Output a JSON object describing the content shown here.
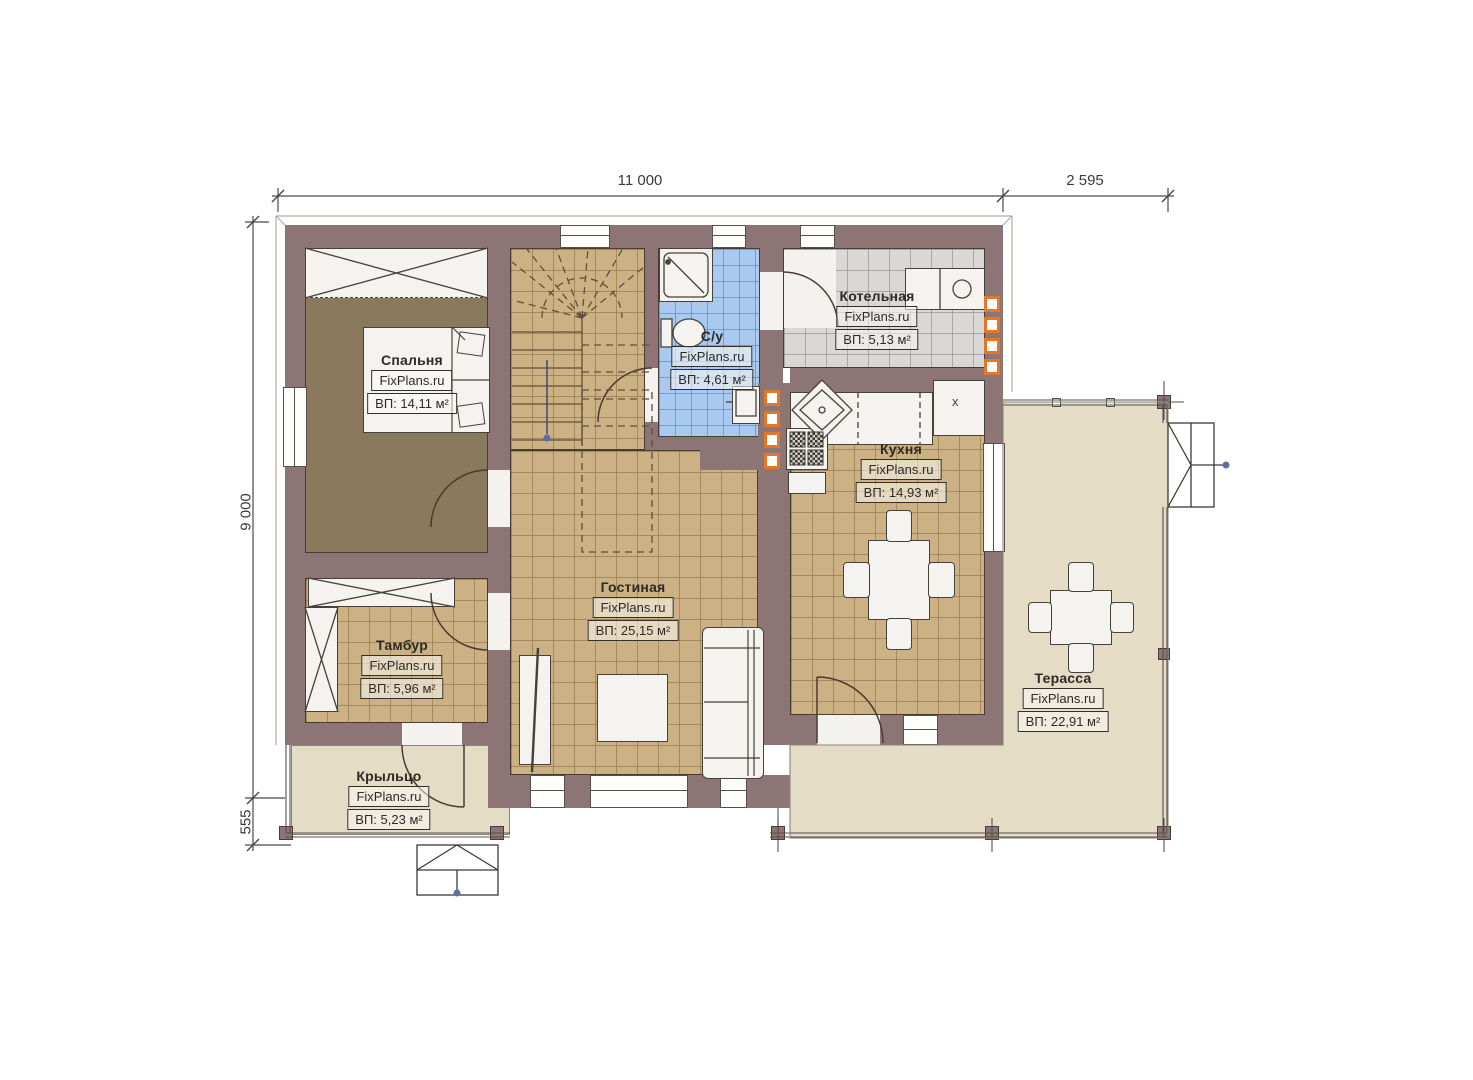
{
  "brand": "FixPlans.ru",
  "dimensions": {
    "top_main": "11 000",
    "top_right": "2 595",
    "left_main": "9 000",
    "left_bottom": "555"
  },
  "rooms": [
    {
      "id": "bedroom",
      "name": "Спальня",
      "brand": "FixPlans.ru",
      "area": "ВП: 14,11 м²"
    },
    {
      "id": "bathroom",
      "name": "С/у",
      "brand": "FixPlans.ru",
      "area": "ВП: 4,61 м²"
    },
    {
      "id": "boiler",
      "name": "Котельная",
      "brand": "FixPlans.ru",
      "area": "ВП: 5,13 м²"
    },
    {
      "id": "kitchen",
      "name": "Кухня",
      "brand": "FixPlans.ru",
      "area": "ВП: 14,93 м²"
    },
    {
      "id": "living",
      "name": "Гостиная",
      "brand": "FixPlans.ru",
      "area": "ВП: 25,15 м²"
    },
    {
      "id": "vestibule",
      "name": "Тамбур",
      "brand": "FixPlans.ru",
      "area": "ВП: 5,96 м²"
    },
    {
      "id": "porch",
      "name": "Крыльцо",
      "brand": "FixPlans.ru",
      "area": "ВП: 5,23 м²"
    },
    {
      "id": "terrace",
      "name": "Терасса",
      "brand": "FixPlans.ru",
      "area": "ВП: 22,91 м²"
    }
  ],
  "markers": {
    "counter_x": "x"
  },
  "colors": {
    "wall": "#8d7575",
    "tile_tan": "#cbb183",
    "tile_blue": "#a9c9ee",
    "tile_gray": "#d9d8d6",
    "floor_beige": "#e5dcc5",
    "floor_khaki": "#8a795c",
    "accent_orange": "#e0772a",
    "arrow_dot_blue": "#5b6ea8"
  }
}
